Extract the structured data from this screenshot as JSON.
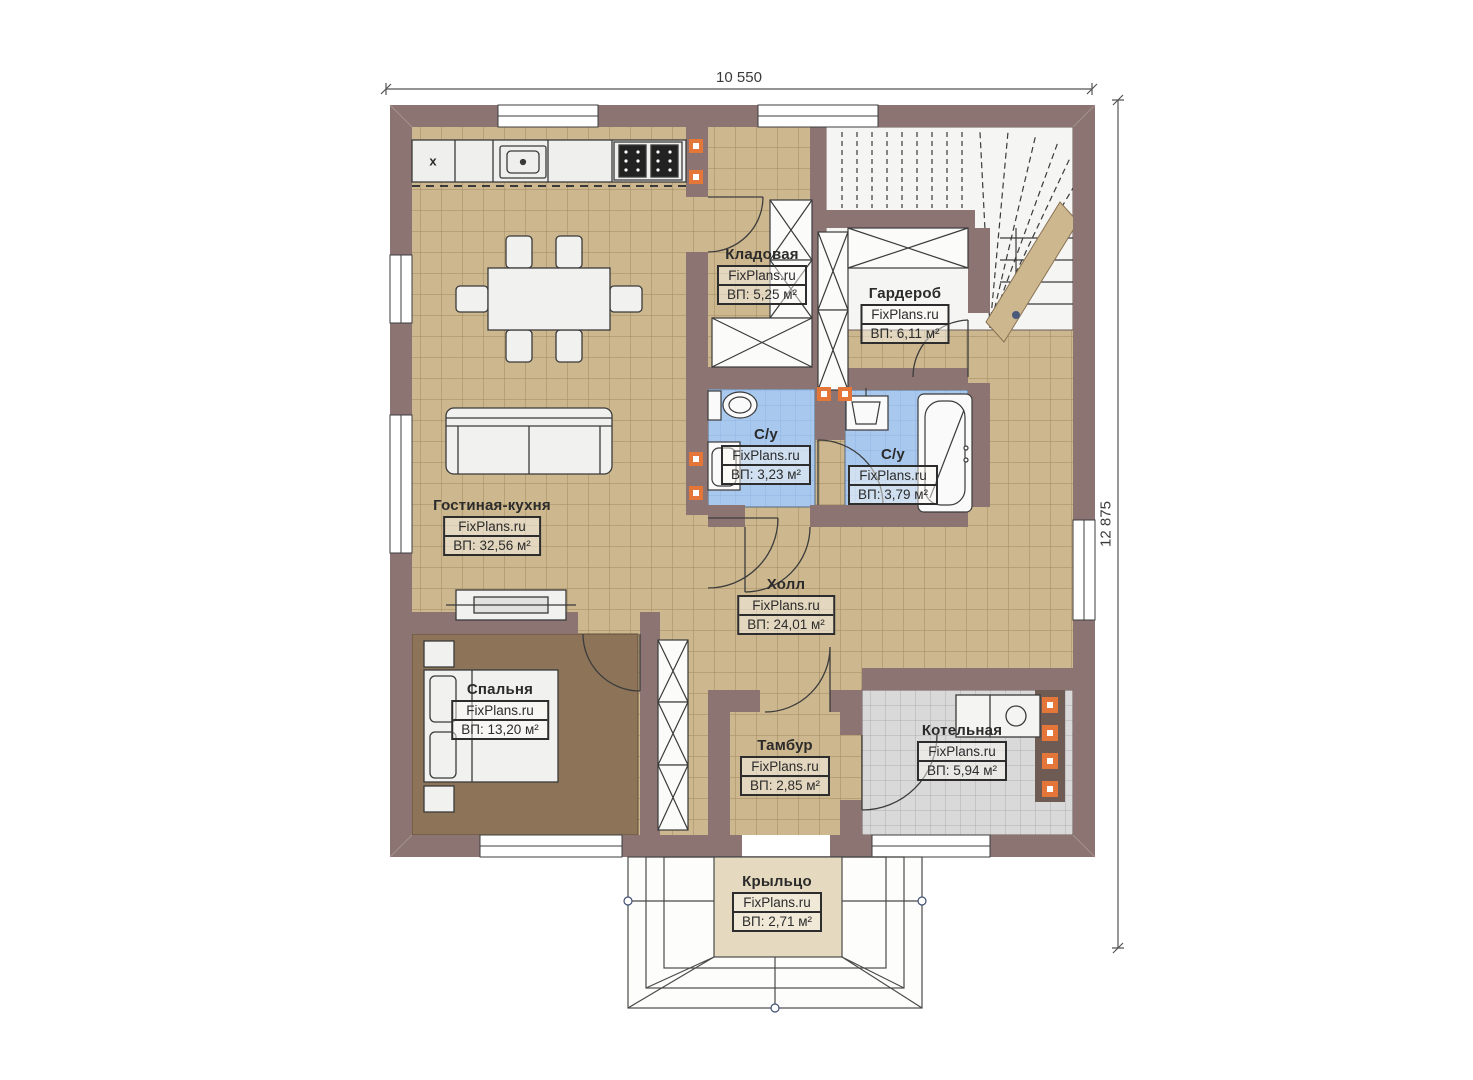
{
  "dimensions": {
    "width_label": "10 550",
    "height_label": "12 875"
  },
  "markers": {
    "kitchen_symbol": "x"
  },
  "rooms": [
    {
      "name": "Кладовая",
      "watermark": "FixPlans.ru",
      "area": "ВП: 5,25 м²"
    },
    {
      "name": "Гардероб",
      "watermark": "FixPlans.ru",
      "area": "ВП: 6,11 м²"
    },
    {
      "name": "С/у",
      "watermark": "FixPlans.ru",
      "area": "ВП: 3,23 м²"
    },
    {
      "name": "С/у",
      "watermark": "FixPlans.ru",
      "area": "ВП: 3,79 м²"
    },
    {
      "name": "Гостиная-кухня",
      "watermark": "FixPlans.ru",
      "area": "ВП: 32,56 м²"
    },
    {
      "name": "Холл",
      "watermark": "FixPlans.ru",
      "area": "ВП: 24,01 м²"
    },
    {
      "name": "Спальня",
      "watermark": "FixPlans.ru",
      "area": "ВП: 13,20 м²"
    },
    {
      "name": "Тамбур",
      "watermark": "FixPlans.ru",
      "area": "ВП: 2,85 м²"
    },
    {
      "name": "Котельная",
      "watermark": "FixPlans.ru",
      "area": "ВП: 5,94 м²"
    },
    {
      "name": "Крыльцо",
      "watermark": "FixPlans.ru",
      "area": "ВП: 2,71 м²"
    }
  ],
  "colors": {
    "wall": "#8b7471",
    "floor_tile": "#cdb78e",
    "floor_grout": "#a18a5e",
    "bedroom_floor": "#8d7459",
    "bathroom_tile": "#a8c8ee",
    "utility_tile": "#d9d9d9",
    "porch_floor": "#e5d9bf",
    "marker_orange": "#e5763a",
    "outline": "#3a3a3a"
  }
}
